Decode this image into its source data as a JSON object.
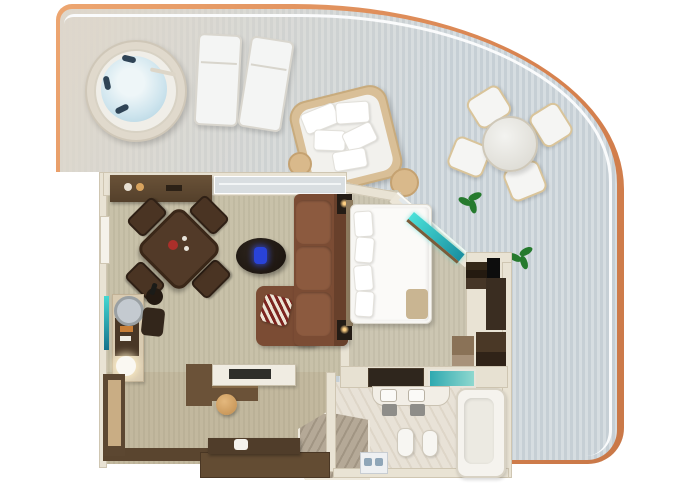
{
  "scene": {
    "type": "3d-floorplan-top-view",
    "description": "Rendered top-down floor plan of a luxury suite with wraparound balcony",
    "visible_text": "none"
  },
  "rooms": [
    {
      "id": "balcony",
      "label": "Wraparound balcony",
      "furniture": [
        "whirlpool hot tub",
        "sun lounger",
        "sun lounger",
        "round daybed with white pillows",
        "side table",
        "side table",
        "round dining table",
        "dining chair x4",
        "potted plant",
        "potted plant",
        "orange railing band",
        "white handrail"
      ]
    },
    {
      "id": "living-room",
      "label": "Living room",
      "furniture": [
        "sideboard",
        "square dark-wood dining table",
        "dining chair x4",
        "wine bucket stand",
        "writing desk with round mirror and lamp",
        "desk chair",
        "teal wall art",
        "L-shaped brown sectional sofa",
        "red striped accent pillow",
        "oval dark coffee table",
        "blue glass vase"
      ]
    },
    {
      "id": "bedroom",
      "label": "Bedroom",
      "furniture": [
        "double bed with white duvet",
        "pillows",
        "tan throw blanket",
        "nightstand with lamp",
        "nightstand with lamp",
        "teal-lit vanity desk on angled wall",
        "wall TV",
        "dark step shelves"
      ]
    },
    {
      "id": "dressing",
      "label": "Dressing area",
      "furniture": [
        "dark wood wardrobe cabinets",
        "open shelf unit",
        "counter with teal tray"
      ]
    },
    {
      "id": "closet",
      "label": "Walk-in closet",
      "furniture": [
        "island counter",
        "vanity desk",
        "round tan stool",
        "wood bench with towel",
        "wardrobe"
      ]
    },
    {
      "id": "bathroom",
      "label": "Bathroom",
      "furniture": [
        "double sink vanity",
        "hanging towels",
        "toilet",
        "bidet",
        "corner bathtub",
        "marble corner shower",
        "shower fixtures"
      ]
    }
  ],
  "palette": {
    "background": "#ffffff",
    "trim_orange": "#e3955f",
    "deck_cool": "#c6cfd5",
    "deck_warm": "#dcd7cd",
    "rail_white": "#fafbfc",
    "wall_cream": "#e9e3d4",
    "carpet_living": "#c8c1a9",
    "carpet_bedroom": "#ccc6b2",
    "carpet_closet": "#c2b89e",
    "marble": "#e8e2d7",
    "marble_shower": "#b5a997",
    "wood_dark": "#54402b",
    "wood_bench": "#503d2a",
    "sofa": "#7b4c34",
    "sofa_cushion": "#8c5a3f",
    "table_wood": "#523a28",
    "bed_white": "#f7f6f3",
    "teal_accent": "#2fc4c4",
    "vase_blue": "#2943d8",
    "plant_green": "#267a2e",
    "stool_tan": "#d7a369",
    "water_blue": "#bedef0",
    "tv_black": "#0d0d0d",
    "glow_warm": "#ffd084"
  }
}
